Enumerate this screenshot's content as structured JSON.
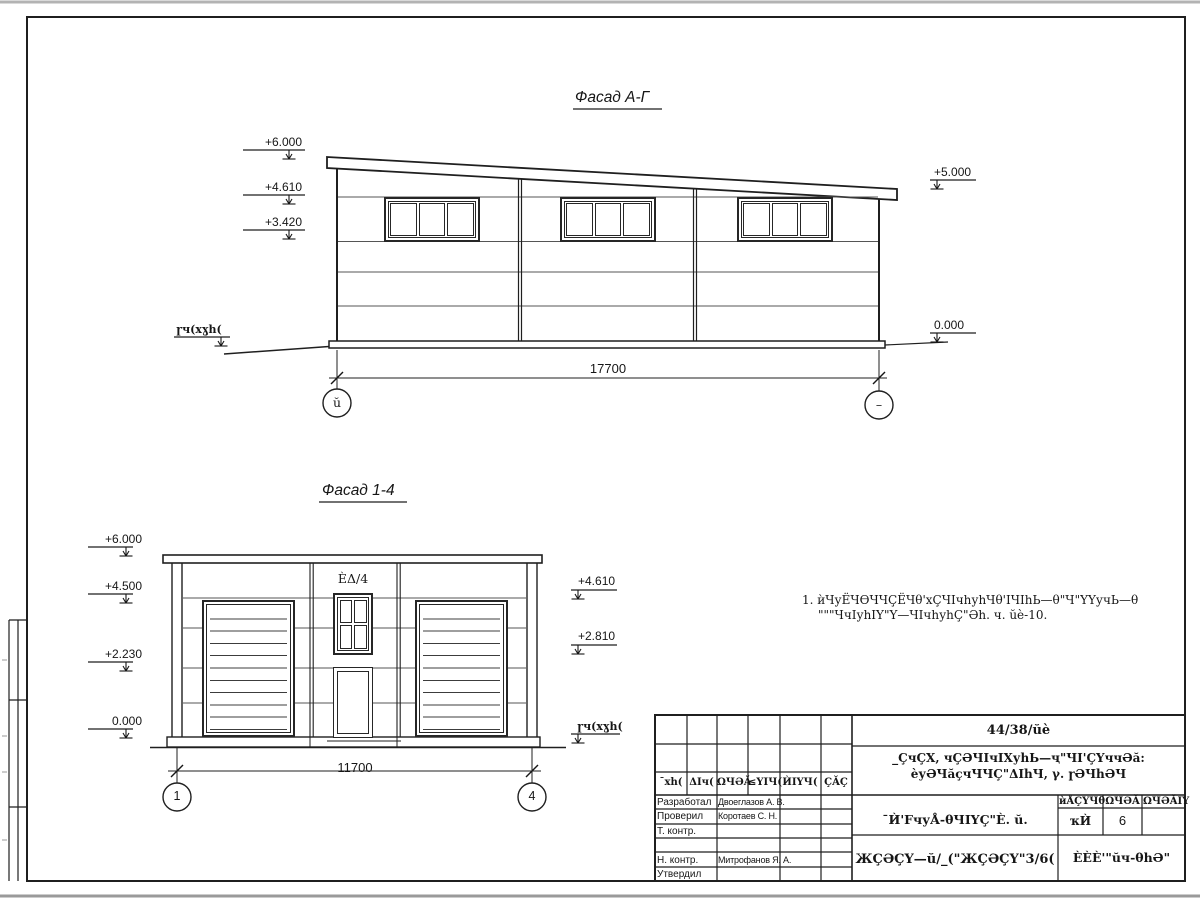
{
  "facade_ag": {
    "title": "Фасад А-Г",
    "marks_left": [
      "+6.000",
      "+4.610",
      "+3.420"
    ],
    "marks_right": [
      "+5.000",
      "0.000"
    ],
    "ground_label": "ɼч(хɣh(",
    "dimension": "17700",
    "axis_left": "ŭ",
    "axis_right": "–"
  },
  "facade_14": {
    "title": "Фасад 1-4",
    "marks_left": [
      "+6.000",
      "+4.500",
      "+2.230",
      "0.000"
    ],
    "marks_right": [
      "+4.610",
      "+2.810"
    ],
    "ground_label": "ɼч(хɣh(",
    "door_label": "ÈΔ/4",
    "dimension": "11700",
    "axis_left": "1",
    "axis_right": "4"
  },
  "note": {
    "line1": "1. ѝЧуЁЧѲЧЧÇЁЧθ'хÇЧIчhуhЧθ'IЧIhЬ—θ\"Ч\"ҮҮучЬ—θ",
    "line2": "\"\"\"ЧчIуhIҮ\"Ү—ЧIчhуhÇ\"Әh. ч. ŭè-10."
  },
  "title_block": {
    "code": "44/38/ŭè",
    "object_line1": "_ÇчÇХ, чÇӘЧIчIХуhЬ—ҷ\"ЧI'ÇҮччӘă:",
    "object_line2": "èуӘЧăçчЧЧÇ\"ΔIhЧ, γ. ɼӘЧhӘЧ",
    "doc_name": "¯Ѝ'FчуÅ-θЧIҮÇ\"È. ŭ.",
    "doc_code": "ЖÇӘÇҮ—ŭ/_(\"ЖÇӘÇҮ\"3/6(",
    "company": "ÈÈÈ'\"ŭч-θhӘ\"",
    "rev_headers": [
      "¯хh(",
      "ΔIч(",
      "ΩЧӘĂ",
      "≤ҮIЧ(",
      "ЍIҮЧ(",
      "ÇĂÇ"
    ],
    "sign_rows": [
      {
        "role": "Разработал",
        "name": "Двоеглазов А. В."
      },
      {
        "role": "Проверил",
        "name": "Коротаев С. Н."
      },
      {
        "role": "Т. контр.",
        "name": ""
      },
      {
        "role": "",
        "name": ""
      },
      {
        "role": "Н. контр.",
        "name": "Митрофанов Я. А."
      },
      {
        "role": "Утвердил",
        "name": ""
      }
    ],
    "stage_headers": [
      "ѝÅÇҮЧθ",
      "ΩЧӘĂ",
      "ΩЧӘĂIҮ"
    ],
    "stage_values": [
      "ҡЍ",
      "6",
      ""
    ]
  }
}
